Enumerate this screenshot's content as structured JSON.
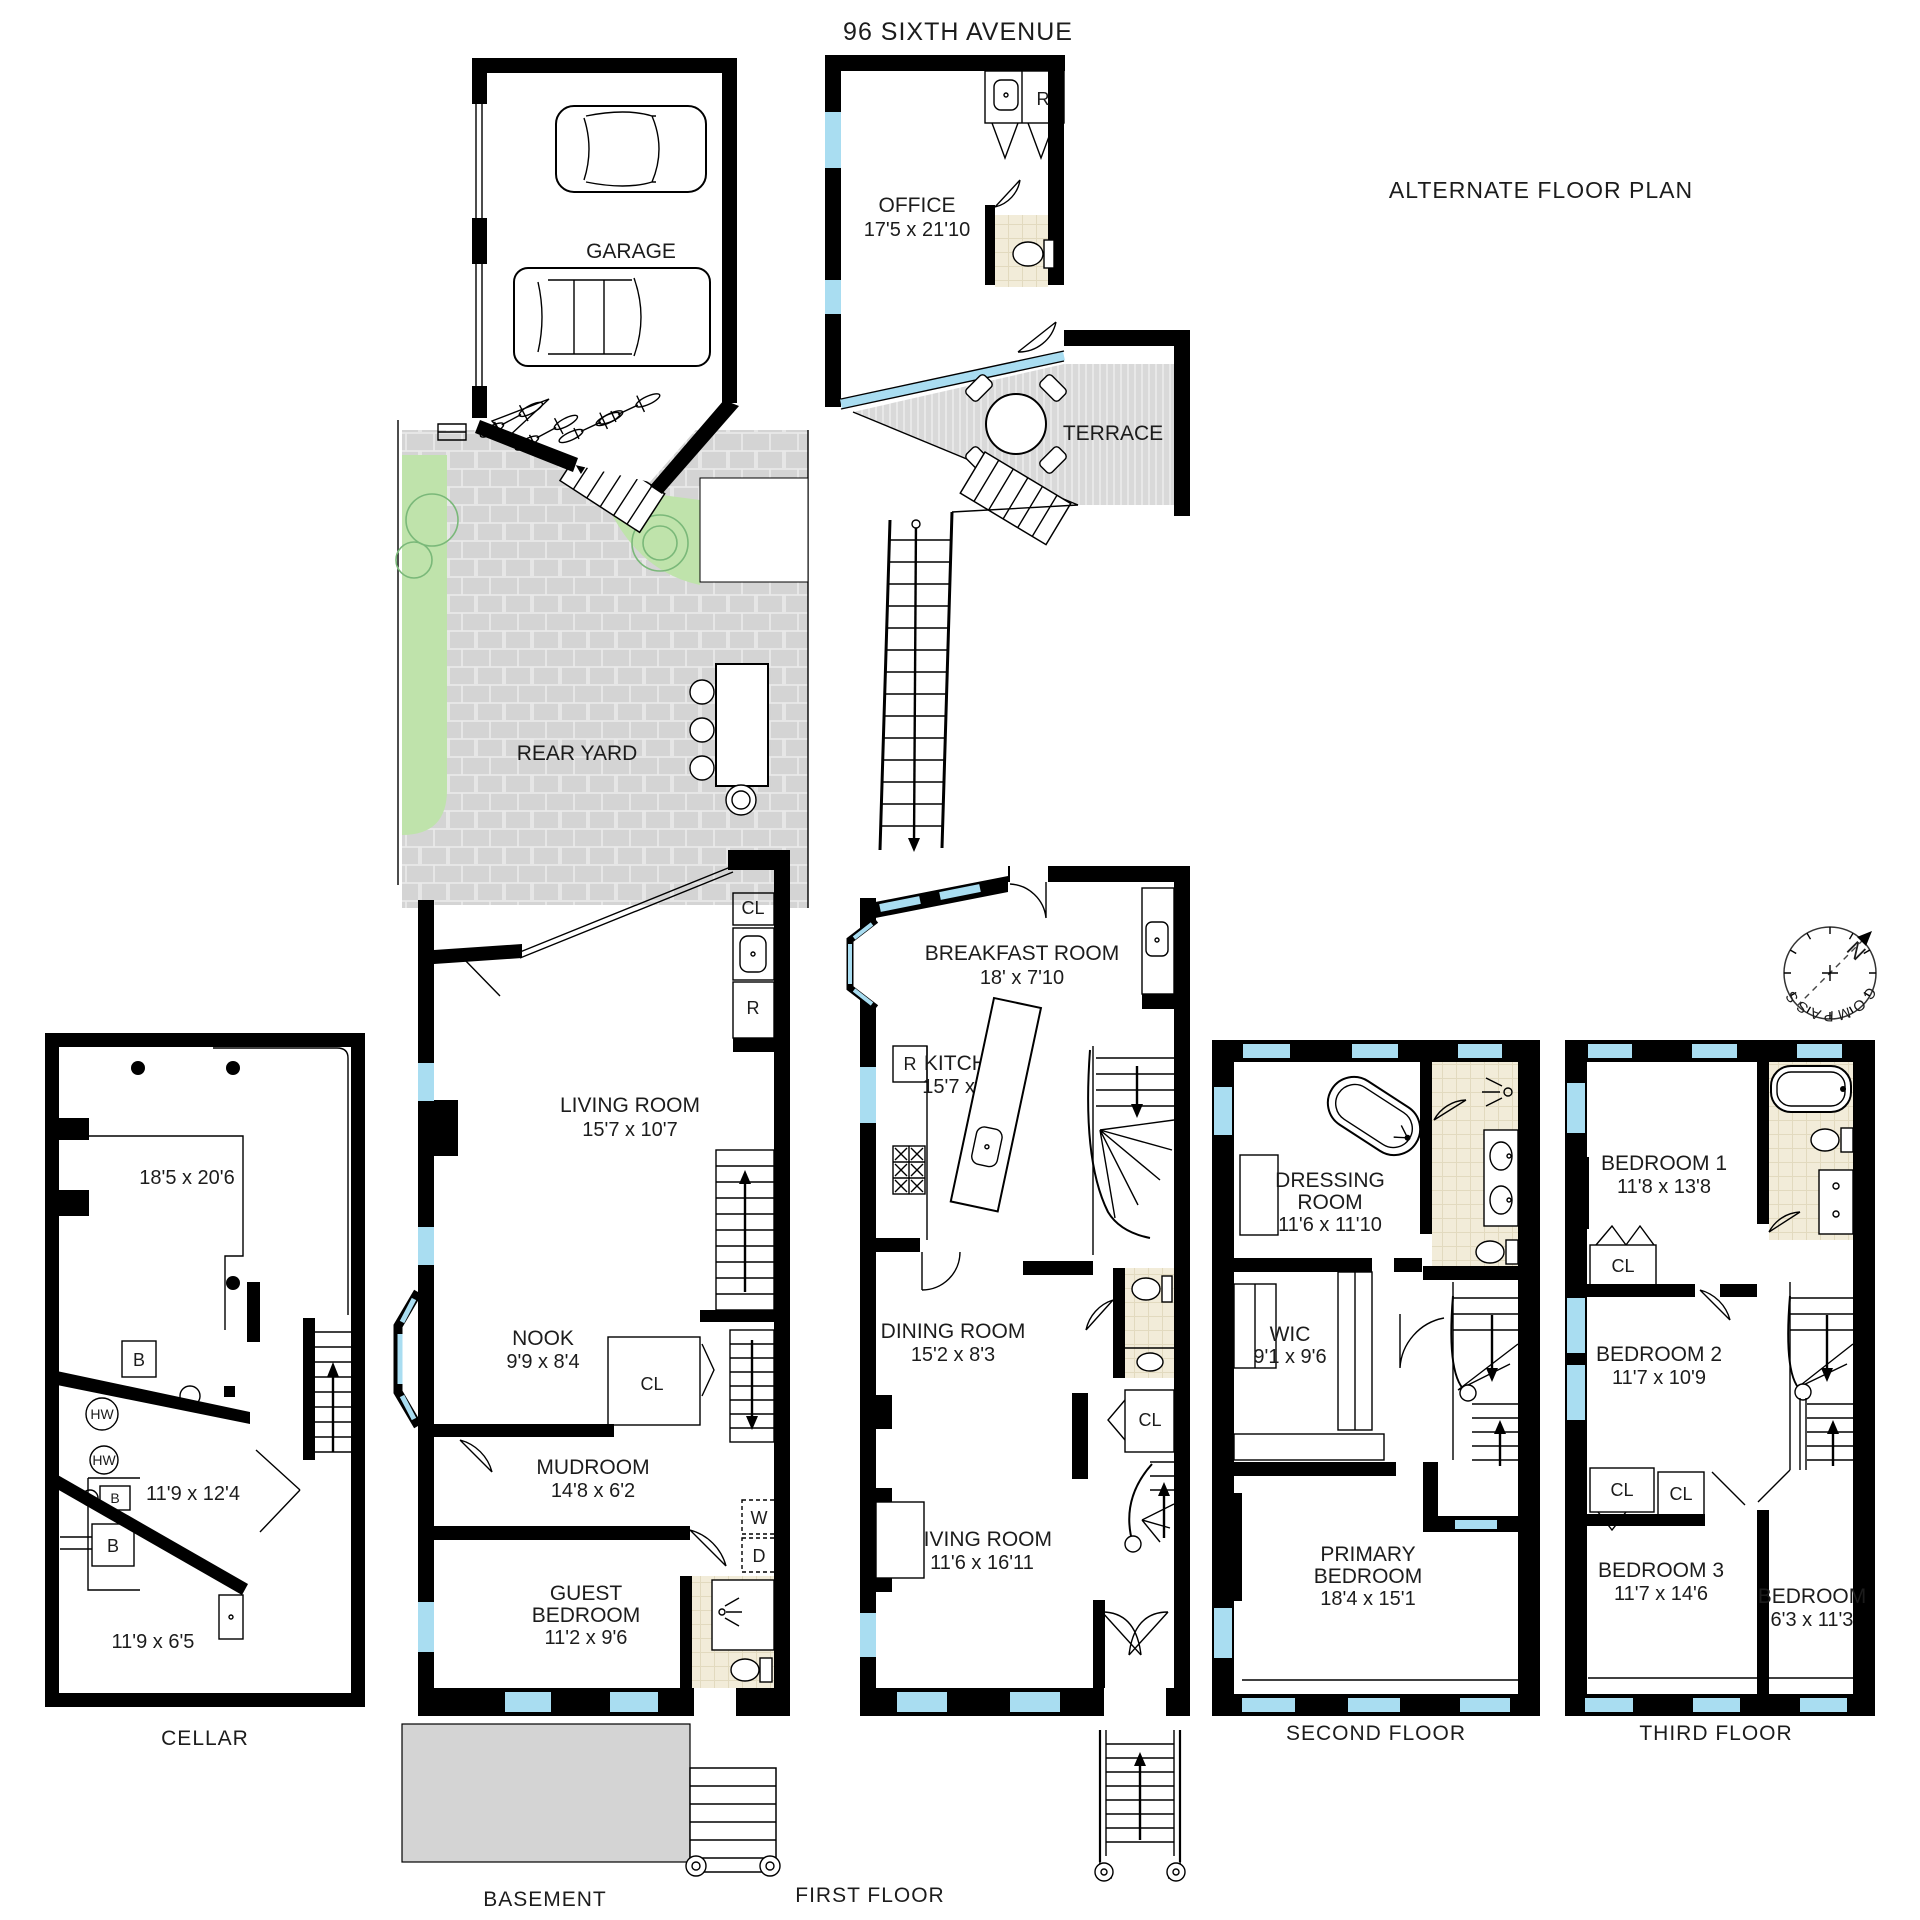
{
  "header": {
    "title": "96 SIXTH AVENUE",
    "subtitle": "ALTERNATE FLOOR PLAN"
  },
  "compass": {
    "label": "COMPASS",
    "north": "N"
  },
  "colors": {
    "wall": "#000000",
    "window": "#a9ddf1",
    "paving": "#d4d4d4",
    "planting": "#bfe3ab",
    "bath_floor": "#f2ecd9",
    "north_arrow": "#c9302c"
  },
  "floors": {
    "cellar": {
      "label": "CELLAR",
      "storage_dims": "18'5 x 20'6",
      "mid_dims": "11'9 x 12'4",
      "front_dims": "11'9 x 6'5",
      "boiler": "B",
      "hot_water": "HW"
    },
    "basement": {
      "label": "BASEMENT",
      "garage": "GARAGE",
      "rear_yard": "REAR YARD",
      "living_room": {
        "name": "LIVING ROOM",
        "dims": "15'7 x 10'7"
      },
      "nook": {
        "name": "NOOK",
        "dims": "9'9 x 8'4"
      },
      "mudroom": {
        "name": "MUDROOM",
        "dims": "14'8 x 6'2"
      },
      "guest_bedroom": {
        "line1": "GUEST",
        "line2": "BEDROOM",
        "dims": "11'2 x 9'6"
      },
      "closet": "CL",
      "refrigerator": "R",
      "washer": "W",
      "dryer": "D"
    },
    "first": {
      "label": "FIRST FLOOR",
      "office": {
        "name": "OFFICE",
        "dims": "17'5 x 21'10"
      },
      "terrace": "TERRACE",
      "breakfast": {
        "name": "BREAKFAST ROOM",
        "dims": "18' x 7'10"
      },
      "kitchen": {
        "name": "KITCHEN",
        "dims": "15'7 x 13'5"
      },
      "dining": {
        "name": "DINING ROOM",
        "dims": "15'2 x 8'3"
      },
      "living": {
        "name": "LIVING ROOM",
        "dims": "11'6 x 16'11"
      },
      "closet": "CL",
      "refrigerator": "R"
    },
    "second": {
      "label": "SECOND FLOOR",
      "dressing": {
        "line1": "DRESSING",
        "line2": "ROOM",
        "dims": "11'6 x 11'10"
      },
      "wic": {
        "name": "WIC",
        "dims": "9'1 x 9'6"
      },
      "primary": {
        "line1": "PRIMARY",
        "line2": "BEDROOM",
        "dims": "18'4 x 15'1"
      }
    },
    "third": {
      "label": "THIRD FLOOR",
      "bedroom1": {
        "name": "BEDROOM 1",
        "dims": "11'8 x 13'8"
      },
      "bedroom2": {
        "name": "BEDROOM 2",
        "dims": "11'7 x 10'9"
      },
      "bedroom3": {
        "name": "BEDROOM 3",
        "dims": "11'7 x 14'6"
      },
      "bedroom4": {
        "name": "BEDROOM",
        "dims": "6'3 x 11'3"
      },
      "closet": "CL"
    }
  }
}
